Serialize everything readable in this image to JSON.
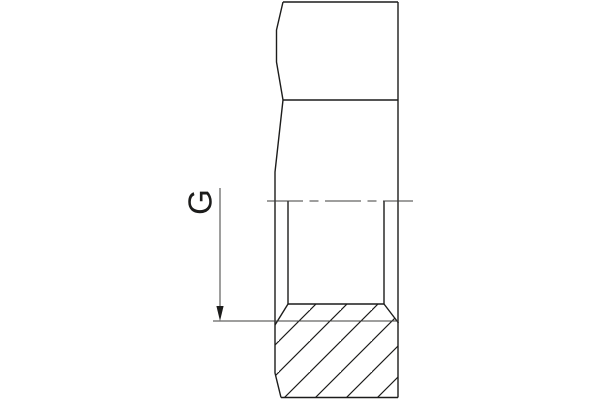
{
  "drawing": {
    "title": "threaded-fitting-section-view",
    "thread_label": "G",
    "line_color": "#1c1c1b",
    "thin_line_color": "#3c3c3b",
    "background": "#ffffff"
  }
}
